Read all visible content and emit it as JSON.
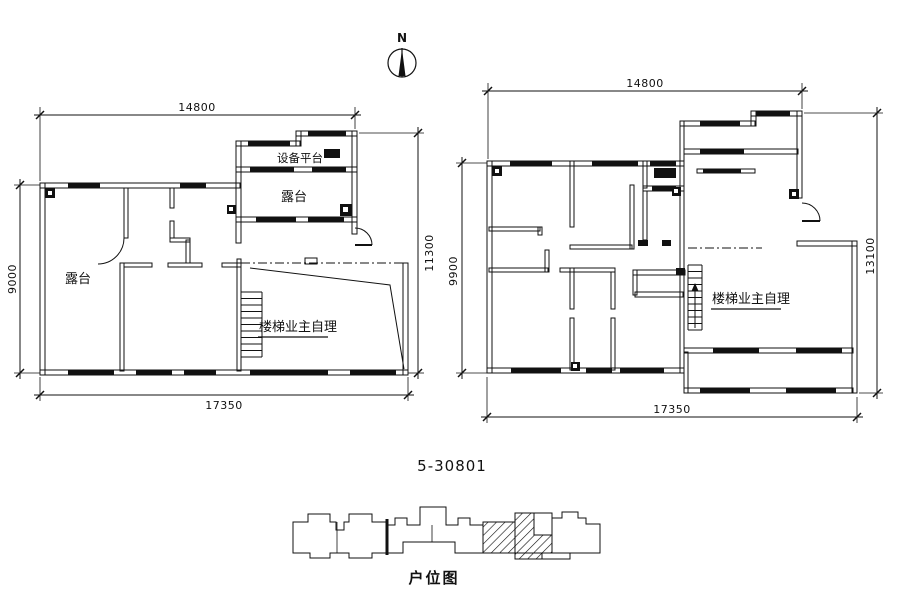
{
  "page": {
    "background": "#ffffff",
    "ink": "#111111"
  },
  "north_arrow": {
    "label": "N"
  },
  "plan_title": "5-30801",
  "key_plan": {
    "label": "户位图"
  },
  "left_plan": {
    "dim_top": "14800",
    "dim_left": "9000",
    "dim_right": "11300",
    "dim_bottom": "17350",
    "room_equipment_platform": "设备平台",
    "room_terrace_upper": "露台",
    "room_terrace_left": "露台",
    "stairs_note": "楼梯业主自理"
  },
  "right_plan": {
    "dim_top": "14800",
    "dim_left": "9900",
    "dim_right": "13100",
    "dim_bottom": "17350",
    "stairs_note": "楼梯业主自理"
  }
}
